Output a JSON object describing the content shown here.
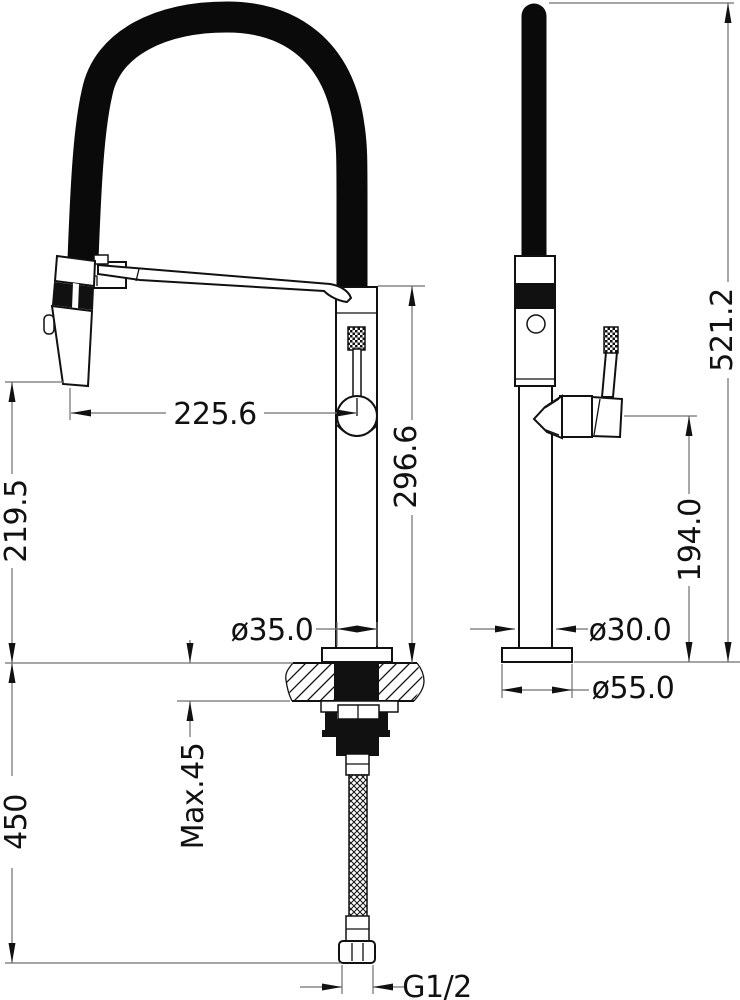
{
  "drawing": {
    "type": "technical-dimension-drawing",
    "subject": "pull-down kitchen faucet, front and side views",
    "colors": {
      "background": "#ffffff",
      "object_line": "#111111",
      "dimension_line": "#6f6f6f",
      "text": "#111111"
    }
  },
  "dims": {
    "spout_reach": "225.6",
    "spout_outlet_height": "219.5",
    "body_top_height": "296.6",
    "deck_hole_dia": "ø35.0",
    "max_deck_thickness": "Max.45",
    "supply_hose_length": "450",
    "thread_size": "G1/2",
    "overall_height": "521.2",
    "handle_height": "194.0",
    "body_dia": "ø30.0",
    "base_dia": "ø55.0"
  }
}
